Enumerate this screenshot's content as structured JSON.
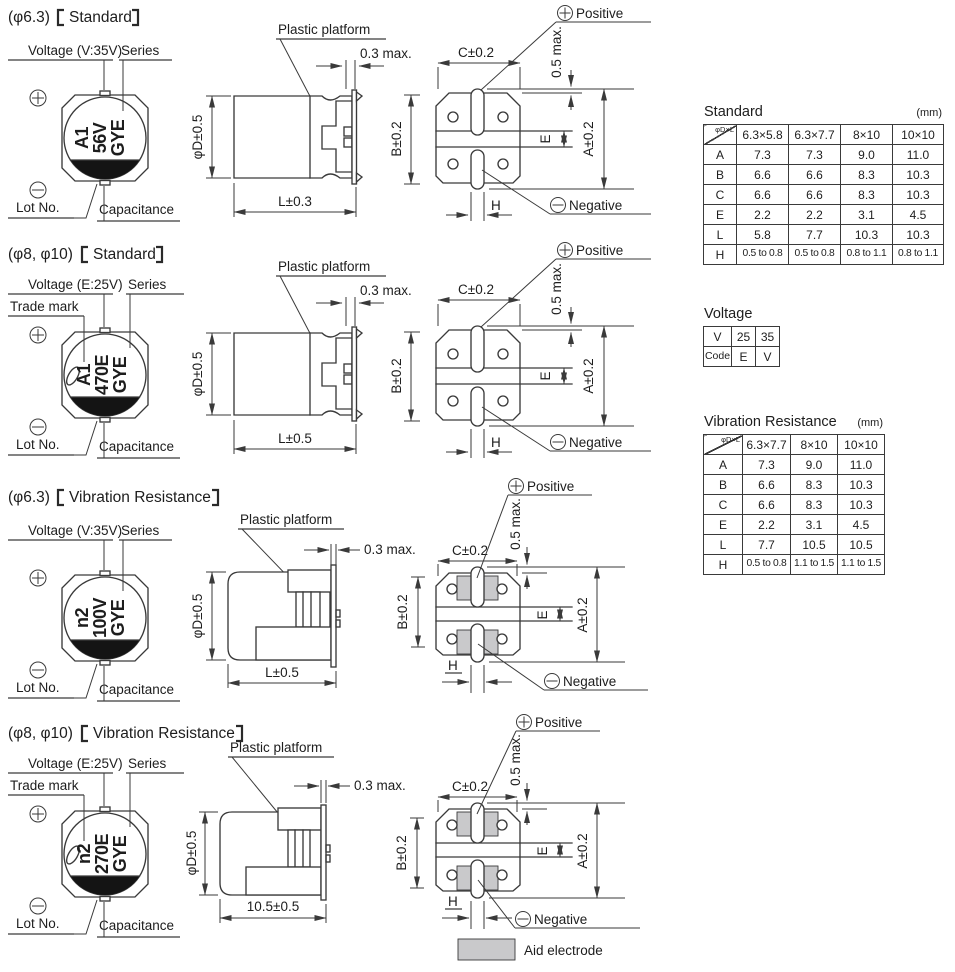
{
  "colors": {
    "line": "#3a3a3a",
    "pad_gray": "#c9c9cb",
    "marking_black": "#141414"
  },
  "sections": [
    {
      "title": {
        "prefix": "(φ6.3)",
        "name": "Standard"
      },
      "labels": {
        "voltage": "Voltage (V:35V)",
        "series": "Series",
        "lot": "Lot No.",
        "capacitance": "Capacitance",
        "platform": "Plastic platform",
        "positive": "Positive",
        "negative": "Negative"
      },
      "marking": [
        "A1",
        "56V",
        "GYE"
      ],
      "dims": {
        "clearance": "0.3 max.",
        "diameter": "φD±0.5",
        "length": "L±0.3",
        "b": "B±0.2",
        "c": "C±0.2",
        "protrusion": "0.5 max.",
        "e": "E",
        "a": "A±0.2",
        "h": "H"
      }
    },
    {
      "title": {
        "prefix": "(φ8, φ10)",
        "name": "Standard"
      },
      "labels": {
        "voltage": "Voltage (E:25V)",
        "series": "Series",
        "trademark": "Trade mark",
        "lot": "Lot No.",
        "capacitance": "Capacitance",
        "platform": "Plastic platform",
        "positive": "Positive",
        "negative": "Negative"
      },
      "marking": [
        "A1",
        "470E",
        "GYE"
      ],
      "dims": {
        "clearance": "0.3 max.",
        "diameter": "φD±0.5",
        "length": "L±0.5",
        "b": "B±0.2",
        "c": "C±0.2",
        "protrusion": "0.5 max.",
        "e": "E",
        "a": "A±0.2",
        "h": "H"
      }
    },
    {
      "title": {
        "prefix": "(φ6.3)",
        "name": "Vibration Resistance"
      },
      "labels": {
        "voltage": "Voltage (V:35V)",
        "series": "Series",
        "lot": "Lot No.",
        "capacitance": "Capacitance",
        "platform": "Plastic platform",
        "positive": "Positive",
        "negative": "Negative"
      },
      "marking": [
        "n2",
        "100V",
        "GYE"
      ],
      "dims": {
        "clearance": "0.3 max.",
        "diameter": "φD±0.5",
        "length": "L±0.5",
        "b": "B±0.2",
        "c": "C±0.2",
        "protrusion": "0.5 max.",
        "e": "E",
        "a": "A±0.2",
        "h": "H"
      }
    },
    {
      "title": {
        "prefix": "(φ8, φ10)",
        "name": "Vibration Resistance"
      },
      "labels": {
        "voltage": "Voltage (E:25V)",
        "series": "Series",
        "trademark": "Trade mark",
        "lot": "Lot No.",
        "capacitance": "Capacitance",
        "platform": "Plastic platform",
        "positive": "Positive",
        "negative": "Negative"
      },
      "marking": [
        "n2",
        "270E",
        "GYE"
      ],
      "dims": {
        "clearance": "0.3 max.",
        "diameter": "φD±0.5",
        "length": "10.5±0.5",
        "b": "B±0.2",
        "c": "C±0.2",
        "protrusion": "0.5 max.",
        "e": "E",
        "a": "A±0.2",
        "h": "H"
      }
    }
  ],
  "tables": {
    "standard": {
      "title": "Standard",
      "unit": "(mm)",
      "corner": "φD×L",
      "columns": [
        "6.3×5.8",
        "6.3×7.7",
        "8×10",
        "10×10"
      ],
      "rows": [
        {
          "label": "A",
          "values": [
            "7.3",
            "7.3",
            "9.0",
            "11.0"
          ]
        },
        {
          "label": "B",
          "values": [
            "6.6",
            "6.6",
            "8.3",
            "10.3"
          ]
        },
        {
          "label": "C",
          "values": [
            "6.6",
            "6.6",
            "8.3",
            "10.3"
          ]
        },
        {
          "label": "E",
          "values": [
            "2.2",
            "2.2",
            "3.1",
            "4.5"
          ]
        },
        {
          "label": "L",
          "values": [
            "5.8",
            "7.7",
            "10.3",
            "10.3"
          ]
        },
        {
          "label": "H",
          "values": [
            "0.5 to 0.8",
            "0.5 to 0.8",
            "0.8 to 1.1",
            "0.8 to 1.1"
          ]
        }
      ]
    },
    "voltage": {
      "title": "Voltage",
      "rows": [
        {
          "label": "V",
          "values": [
            "25",
            "35"
          ]
        },
        {
          "label": "Code",
          "values": [
            "E",
            "V"
          ]
        }
      ]
    },
    "vibration": {
      "title": "Vibration Resistance",
      "unit": "(mm)",
      "corner": "φD×L",
      "columns": [
        "6.3×7.7",
        "8×10",
        "10×10"
      ],
      "rows": [
        {
          "label": "A",
          "values": [
            "7.3",
            "9.0",
            "11.0"
          ]
        },
        {
          "label": "B",
          "values": [
            "6.6",
            "8.3",
            "10.3"
          ]
        },
        {
          "label": "C",
          "values": [
            "6.6",
            "8.3",
            "10.3"
          ]
        },
        {
          "label": "E",
          "values": [
            "2.2",
            "3.1",
            "4.5"
          ]
        },
        {
          "label": "L",
          "values": [
            "7.7",
            "10.5",
            "10.5"
          ]
        },
        {
          "label": "H",
          "values": [
            "0.5 to 0.8",
            "1.1 to 1.5",
            "1.1 to 1.5"
          ]
        }
      ]
    }
  },
  "legend": {
    "label": "Aid electrode"
  }
}
